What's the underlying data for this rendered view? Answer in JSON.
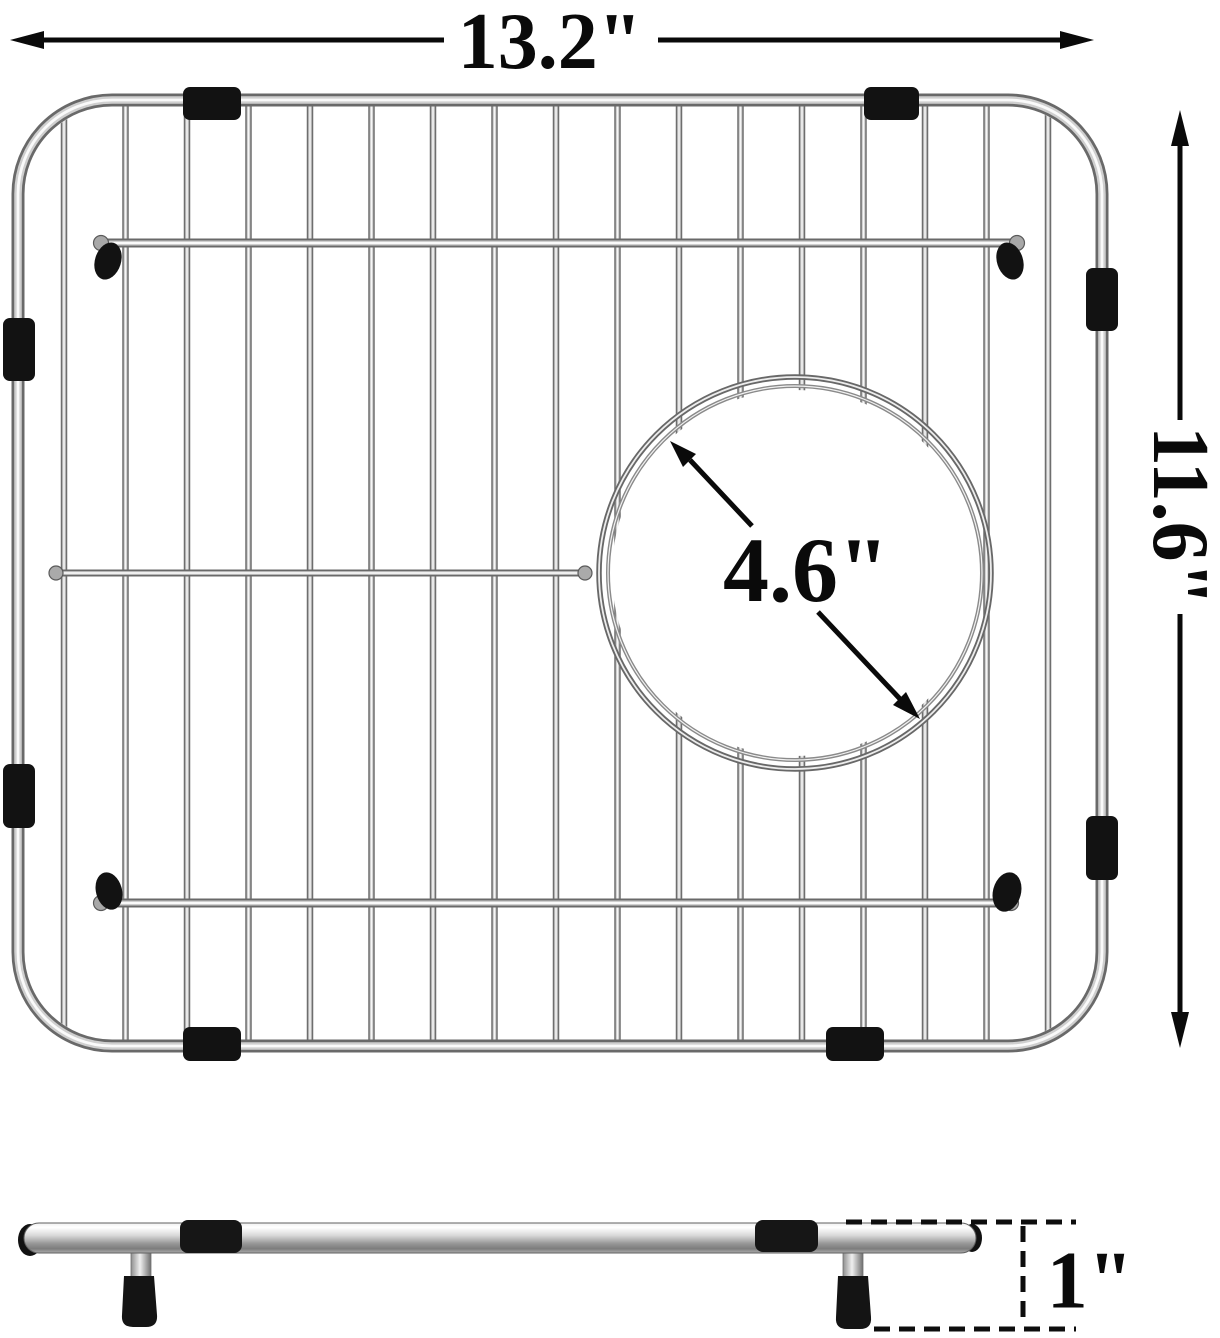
{
  "figure": {
    "description": "Dimension diagram of a stainless steel kitchen sink bottom grid, top view with side profile view below",
    "background_color": "#ffffff",
    "annotation_color": "#0a0a0a"
  },
  "dimensions": {
    "width_label": "13.2\"",
    "height_label": "11.6\"",
    "drain_opening_label": "4.6\"",
    "profile_height_label": "1\""
  },
  "grid": {
    "vertical_wires": {
      "count": 17,
      "x_start": 64,
      "x_end": 1048,
      "y_top": 104,
      "y_bottom": 1042
    },
    "frame": {
      "x": 18,
      "y": 100,
      "width": 1084,
      "height": 946,
      "corner_radius": 94
    },
    "drain_circle": {
      "cx": 795,
      "cy": 573,
      "r_outer": 196,
      "r_inner": 187,
      "mask_r": 183
    },
    "cross_bar_count": 2,
    "rubber_bumper_count": 8
  },
  "side_view": {
    "sleeve_count": 2,
    "feet_count": 2
  },
  "colors": {
    "wire_dark": "#6e6e6e",
    "wire_mid": "#c9c9c9",
    "wire_light": "#f6f6f6",
    "rubber_black": "#121212"
  }
}
